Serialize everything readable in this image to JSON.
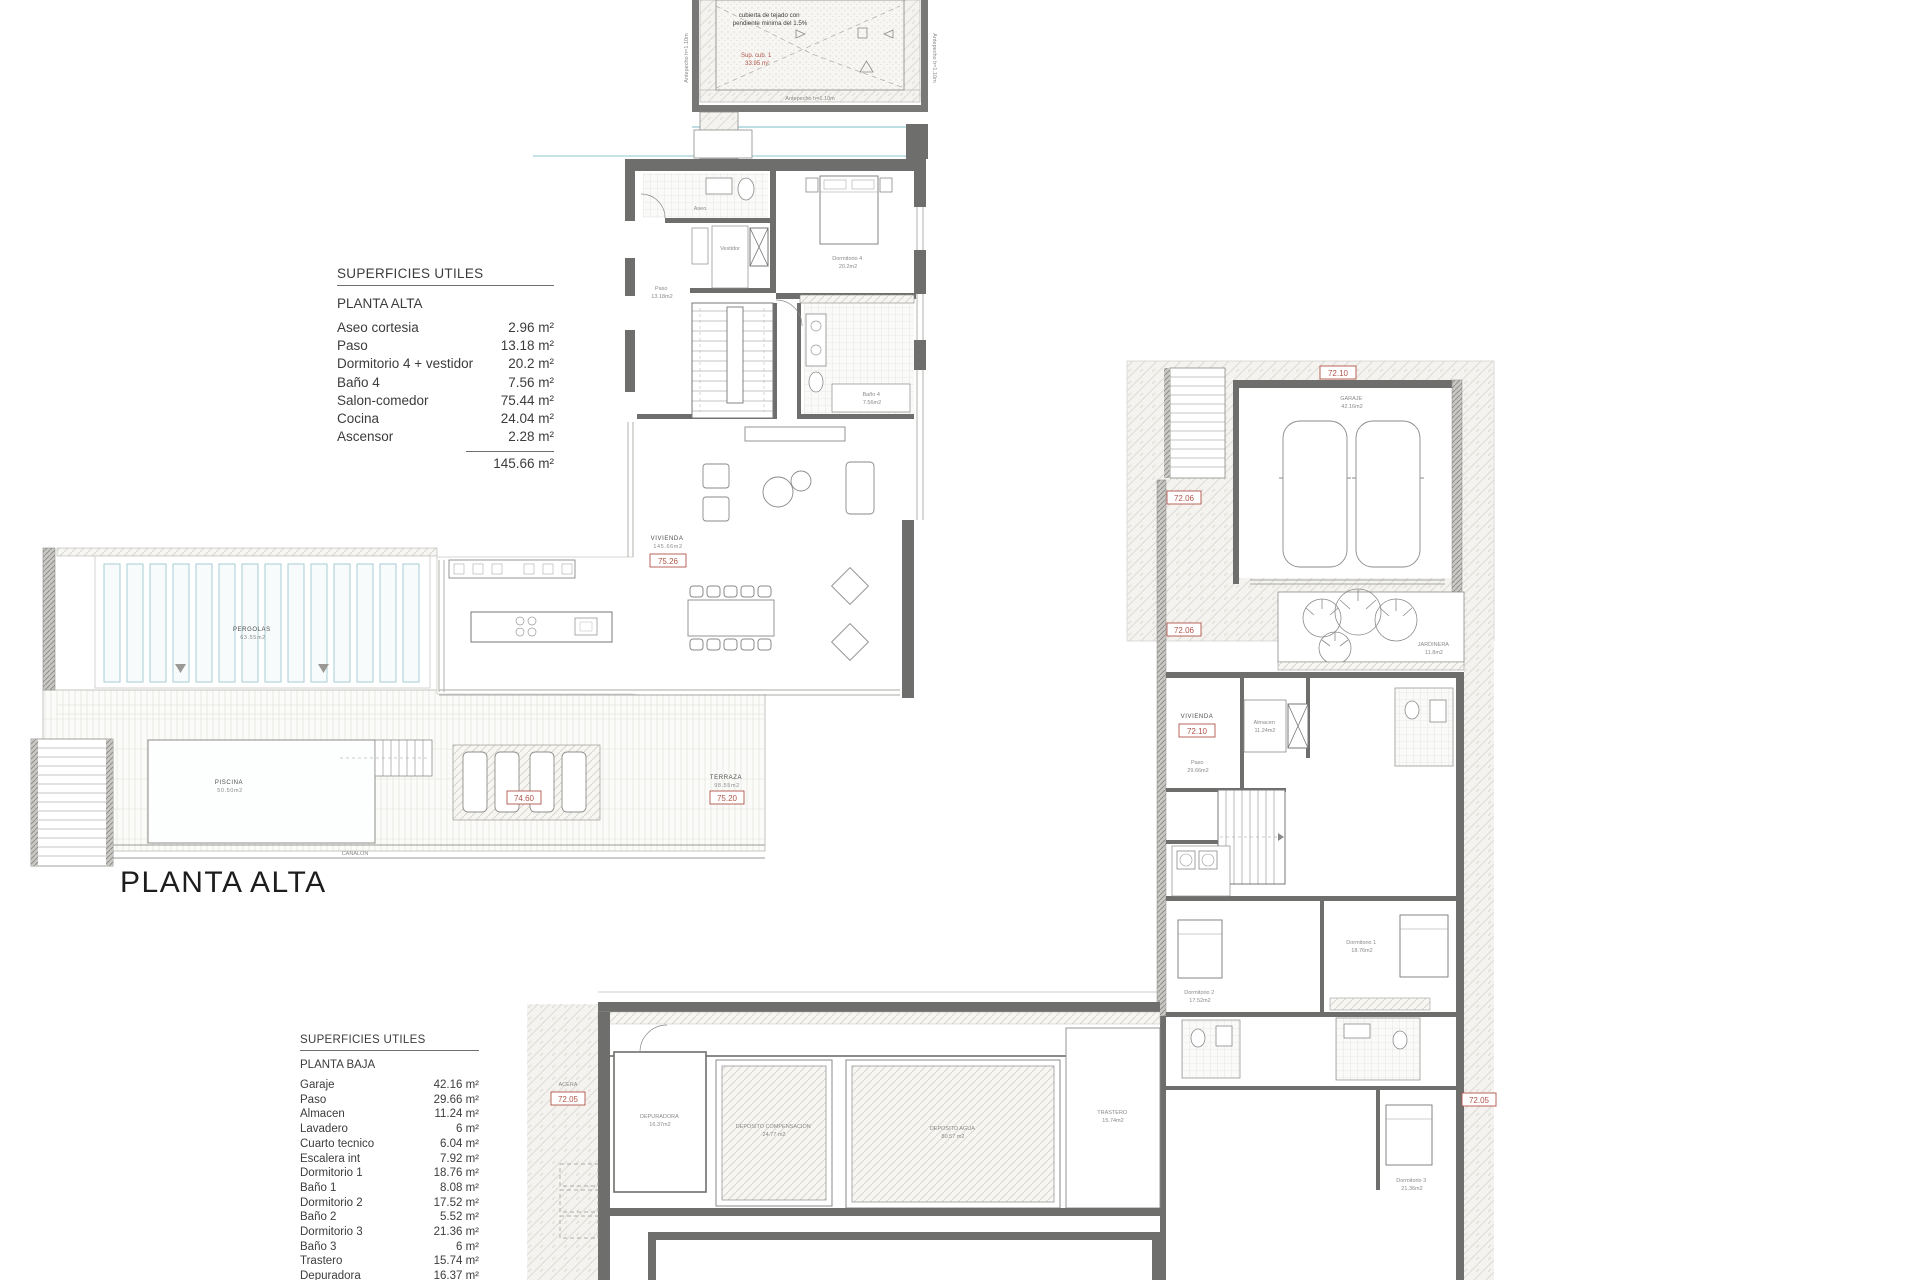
{
  "titles": {
    "planta_alta_label": "PLANTA ALTA"
  },
  "area_tables": {
    "alta": {
      "header": "SUPERFICIES UTILES",
      "floor": "PLANTA ALTA",
      "rows": [
        {
          "label": "Aseo cortesia",
          "value": "2.96 m²"
        },
        {
          "label": "Paso",
          "value": "13.18 m²"
        },
        {
          "label": "Dormitorio 4 + vestidor",
          "value": "20.2 m²"
        },
        {
          "label": "Baño 4",
          "value": "7.56 m²"
        },
        {
          "label": "Salon-comedor",
          "value": "75.44 m²"
        },
        {
          "label": "Cocina",
          "value": "24.04 m²"
        },
        {
          "label": "Ascensor",
          "value": "2.28 m²"
        }
      ],
      "total": "145.66 m²"
    },
    "baja": {
      "header": "SUPERFICIES UTILES",
      "floor": "PLANTA BAJA",
      "rows": [
        {
          "label": "Garaje",
          "value": "42.16 m²"
        },
        {
          "label": "Paso",
          "value": "29.66 m²"
        },
        {
          "label": "Almacen",
          "value": "11.24 m²"
        },
        {
          "label": "Lavadero",
          "value": "6 m²"
        },
        {
          "label": "Cuarto tecnico",
          "value": "6.04 m²"
        },
        {
          "label": "Escalera int",
          "value": "7.92 m²"
        },
        {
          "label": "Dormitorio 1",
          "value": "18.76 m²"
        },
        {
          "label": "Baño 1",
          "value": "8.08 m²"
        },
        {
          "label": "Dormitorio 2",
          "value": "17.52 m²"
        },
        {
          "label": "Baño 2",
          "value": "5.52 m²"
        },
        {
          "label": "Dormitorio 3",
          "value": "21.36 m²"
        },
        {
          "label": "Baño 3",
          "value": "6 m²"
        },
        {
          "label": "Trastero",
          "value": "15.74 m²"
        },
        {
          "label": "Depuradora",
          "value": "16.37 m²"
        }
      ]
    }
  },
  "roof_plan": {
    "note_line1": "cubierta de tejado con",
    "note_line2": "pendiente minima del 1.5%",
    "sup_line1": "Sup. cub. 1",
    "sup_line2": "33.95 m²",
    "parapet": "Antepecho h=1.10m"
  },
  "levels": {
    "vivienda_alta": "75.26",
    "terraza": "75.20",
    "tumbonas": "74.60",
    "garaje": "72.10",
    "lateral_1": "72.06",
    "lateral_2": "72.06",
    "vivienda_baja": "72.10",
    "acera": "72.05",
    "acera_der": "72.05"
  },
  "plan_labels": {
    "vivienda_alta": {
      "name": "VIVIENDA",
      "area": "145.66m2"
    },
    "terraza": {
      "name": "TERRAZA",
      "area": "98.55m2"
    },
    "pergolas": {
      "name": "PERGOLAS",
      "area": "63.55m2"
    },
    "piscina": {
      "name": "PISCINA",
      "area": "50.50m2"
    },
    "canalon": {
      "name": "CANALON"
    },
    "dormitorio4": {
      "name": "Dormitorio 4",
      "area": "20.2m2"
    },
    "bano4": {
      "name": "Baño 4",
      "area": "7.56m2"
    },
    "aseo": {
      "name": "Aseo",
      "area": "2.96m2"
    },
    "paso_alta": {
      "name": "Paso",
      "area": "13.18m2"
    },
    "vestidor": {
      "name": "Vestidor"
    },
    "garaje": {
      "name": "GARAJE",
      "area": "42.16m2"
    },
    "jardinera": {
      "name": "JARDINERA",
      "area": "11.8m2"
    },
    "almacen": {
      "name": "Almacen",
      "area": "11.24m2"
    },
    "paso_baja": {
      "name": "Paso",
      "area": "29.66m2"
    },
    "vivienda_baja": {
      "name": "VIVIENDA"
    },
    "dormitorio1": {
      "name": "Dormitorio 1",
      "area": "18.76m2"
    },
    "dormitorio2": {
      "name": "Dormitorio 2",
      "area": "17.52m2"
    },
    "dormitorio3": {
      "name": "Dormitorio 3",
      "area": "21.36m2"
    },
    "trastero": {
      "name": "TRASTERO",
      "area": "15.74m2"
    },
    "deposito_comp": {
      "name": "DEPOSITO COMPENSACION",
      "area": "24.77 m2"
    },
    "deposito_agua": {
      "name": "DEPOSITO AGUA",
      "area": "80.57 m2"
    },
    "depuradora": {
      "name": "DEPURADORA",
      "area": "16.37m2"
    },
    "acera": {
      "name": "ACERA"
    }
  }
}
